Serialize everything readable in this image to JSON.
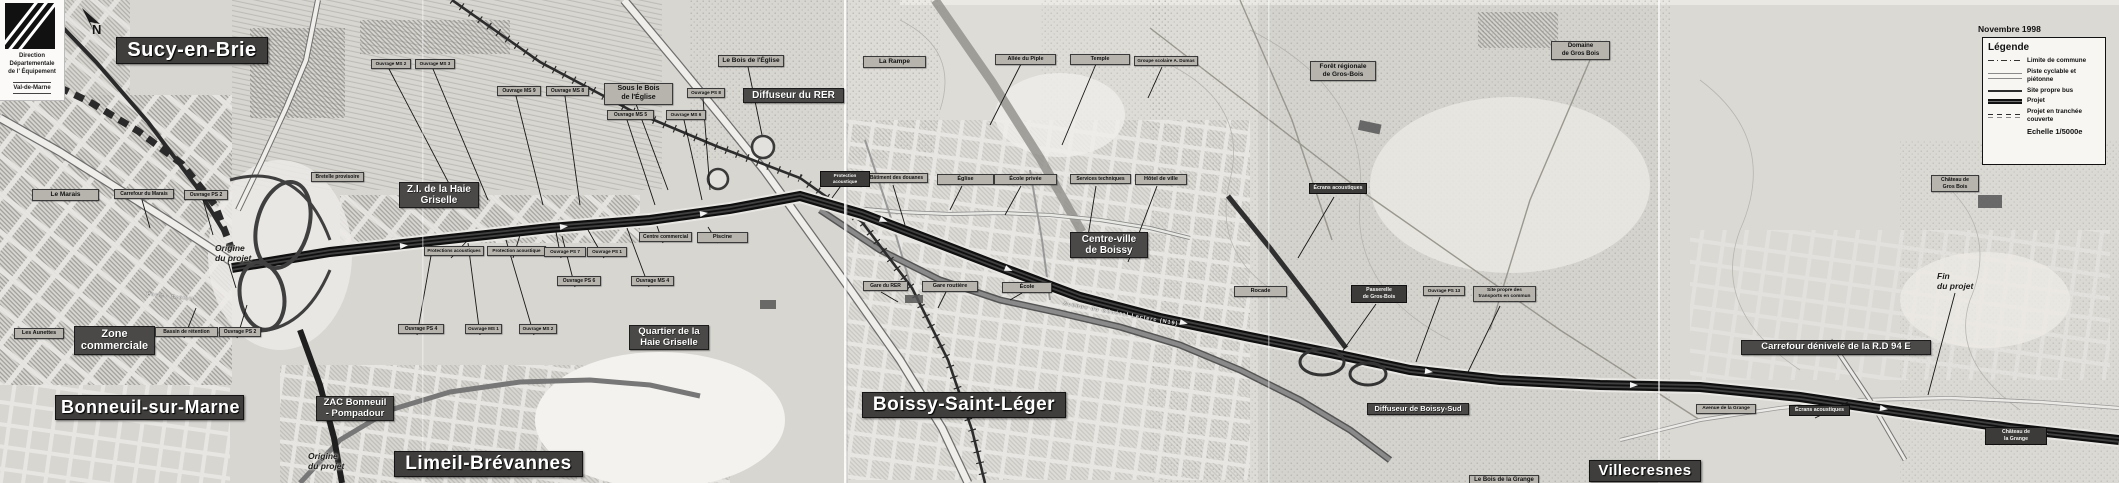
{
  "meta": {
    "date_note": "Novembre 1998"
  },
  "logo": {
    "line1": "Direction",
    "line2": "Départementale",
    "line3": "de l' Équipement",
    "line4": "Val-de-Marne"
  },
  "north": {
    "letter": "N"
  },
  "palette": {
    "paper": "#d8d6d1",
    "banner_dark": "#3f3e3c",
    "label_gray": "#b7b4ae",
    "route_dark": "#161616"
  },
  "legend": {
    "title": "Légende",
    "items": [
      {
        "symbol": "dashdot",
        "label": "Limite de commune"
      },
      {
        "symbol": "double",
        "label": "Piste cyclable et\npiétonne"
      },
      {
        "symbol": "solid",
        "label": "Site propre bus"
      },
      {
        "symbol": "thick",
        "label": "Projet"
      },
      {
        "symbol": "dashes",
        "label": "Projet en tranchée\ncouverte"
      },
      {
        "symbol": "none",
        "label": "Echelle 1/5000e",
        "emph": true
      }
    ]
  },
  "labels": [
    {
      "name": "commune-sucy-en-brie",
      "type": "xl",
      "text": "Sucy-en-Brie",
      "x": 116,
      "y": 37,
      "w": 140,
      "fs": 20
    },
    {
      "name": "commune-bonneuil-sur-marne",
      "type": "xl",
      "text": "Bonneuil-sur-Marne",
      "x": 55,
      "y": 395,
      "w": 177,
      "fs": 18
    },
    {
      "name": "commune-limeil-brevannes",
      "type": "xl",
      "text": "Limeil-Brévannes",
      "x": 394,
      "y": 451,
      "w": 177,
      "fs": 19
    },
    {
      "name": "commune-boissy-saint-leger",
      "type": "xl",
      "text": "Boissy-Saint-Léger",
      "x": 862,
      "y": 392,
      "w": 192,
      "fs": 19
    },
    {
      "name": "commune-villecresnes",
      "type": "xl",
      "text": "Villecresnes",
      "x": 1589,
      "y": 460,
      "w": 100,
      "fs": 15
    },
    {
      "name": "zi-haie-griselle",
      "type": "md",
      "text": "Z.I. de la Haie\nGriselle",
      "x": 399,
      "y": 182,
      "w": 72,
      "fs": 10
    },
    {
      "name": "zone-commerciale",
      "type": "md",
      "text": "Zone\ncommerciale",
      "x": 74,
      "y": 326,
      "w": 73,
      "fs": 11
    },
    {
      "name": "quartier-haie-griselle",
      "type": "md",
      "text": "Quartier de la\nHaie Griselle",
      "x": 629,
      "y": 325,
      "w": 72,
      "fs": 9.5
    },
    {
      "name": "centre-ville-boissy",
      "type": "md",
      "text": "Centre-ville\nde Boissy",
      "x": 1070,
      "y": 232,
      "w": 70,
      "fs": 10
    },
    {
      "name": "diffuseur-du-rer",
      "type": "md",
      "text": "Diffuseur du RER",
      "x": 743,
      "y": 88,
      "w": 93,
      "fs": 10
    },
    {
      "name": "diffuseur-boissy-sud",
      "type": "md",
      "text": "Diffuseur de Boissy-Sud",
      "x": 1367,
      "y": 403,
      "w": 94,
      "fs": 7.5
    },
    {
      "name": "carrefour-denivele-rd94e",
      "type": "md",
      "text": "Carrefour dénivelé de la R.D 94 E",
      "x": 1741,
      "y": 340,
      "w": 182,
      "fs": 9.5
    },
    {
      "name": "zac-bonneuil-pompadour",
      "type": "md",
      "text": "ZAC Bonneuil\n- Pompadour",
      "x": 316,
      "y": 396,
      "w": 70,
      "fs": 9.5
    },
    {
      "name": "le-marais",
      "type": "gray",
      "text": "Le Marais",
      "x": 32,
      "y": 189,
      "w": 61,
      "fs": 6.5
    },
    {
      "name": "carrefour-du-marais",
      "type": "gray",
      "text": "Carrefour du Marais",
      "x": 114,
      "y": 189,
      "w": 54,
      "fs": 5
    },
    {
      "name": "ouvrage-ps2-nord",
      "type": "gray",
      "text": "Ouvrage PS 2",
      "x": 184,
      "y": 190,
      "w": 38,
      "fs": 5
    },
    {
      "name": "les-aunettes",
      "type": "gray",
      "text": "Les Aunettes",
      "x": 14,
      "y": 328,
      "w": 44,
      "fs": 5.5
    },
    {
      "name": "bassin-de-retention",
      "type": "gray",
      "text": "Bassin de rétention",
      "x": 155,
      "y": 327,
      "w": 57,
      "fs": 5
    },
    {
      "name": "ouvrage-ps2-sud",
      "type": "gray",
      "text": "Ouvrage PS 2",
      "x": 219,
      "y": 327,
      "w": 36,
      "fs": 5
    },
    {
      "name": "bretelle-provisoire",
      "type": "gray",
      "text": "Bretelle provisoire",
      "x": 311,
      "y": 172,
      "w": 47,
      "fs": 5
    },
    {
      "name": "ouvrage-ms2-haut",
      "type": "gray",
      "text": "Ouvrage MS 2",
      "x": 371,
      "y": 59,
      "w": 34,
      "fs": 4.6
    },
    {
      "name": "ouvrage-ms3-haut",
      "type": "gray",
      "text": "Ouvrage MS 3",
      "x": 415,
      "y": 59,
      "w": 34,
      "fs": 4.6
    },
    {
      "name": "ouvrage-ms9",
      "type": "gray",
      "text": "Ouvrage MS 9",
      "x": 497,
      "y": 86,
      "w": 38,
      "fs": 5
    },
    {
      "name": "ouvrage-ms8",
      "type": "gray",
      "text": "Ouvrage MS 8",
      "x": 546,
      "y": 86,
      "w": 37,
      "fs": 5
    },
    {
      "name": "sous-le-bois-de-l-eglise",
      "type": "graylg",
      "text": "Sous le Bois\nde l'Église",
      "x": 604,
      "y": 83,
      "w": 63,
      "fs": 7
    },
    {
      "name": "ouvrage-ps8",
      "type": "gray",
      "text": "Ouvrage PS 8",
      "x": 687,
      "y": 88,
      "w": 32,
      "fs": 4.6
    },
    {
      "name": "ouvrage-ms5",
      "type": "gray",
      "text": "Ouvrage MS 5",
      "x": 607,
      "y": 110,
      "w": 41,
      "fs": 5
    },
    {
      "name": "ouvrage-ms6",
      "type": "gray",
      "text": "Ouvrage MS 6",
      "x": 666,
      "y": 110,
      "w": 34,
      "fs": 4.6
    },
    {
      "name": "le-bois-de-l-eglise",
      "type": "graylg",
      "text": "Le Bois de l'Église",
      "x": 718,
      "y": 55,
      "w": 60,
      "fs": 6.5
    },
    {
      "name": "la-rampe",
      "type": "graylg",
      "text": "La Rampe",
      "x": 863,
      "y": 56,
      "w": 57,
      "fs": 6.5
    },
    {
      "name": "protections-acoustiques",
      "type": "gray",
      "text": "Protections acoustiques",
      "x": 424,
      "y": 246,
      "w": 54,
      "fs": 4.6
    },
    {
      "name": "protection-acoustique-n5",
      "type": "gray",
      "text": "Protection acoustique",
      "x": 487,
      "y": 246,
      "w": 53,
      "fs": 4.6
    },
    {
      "name": "ouvrage-ps7",
      "type": "gray",
      "text": "Ouvrage PS 7",
      "x": 544,
      "y": 247,
      "w": 36,
      "fs": 4.6
    },
    {
      "name": "ouvrage-ps1",
      "type": "gray",
      "text": "Ouvrage PS 1",
      "x": 587,
      "y": 247,
      "w": 34,
      "fs": 4.6
    },
    {
      "name": "ouvrage-ps6",
      "type": "gray",
      "text": "Ouvrage PS 6",
      "x": 557,
      "y": 276,
      "w": 38,
      "fs": 5
    },
    {
      "name": "ouvrage-ms4",
      "type": "gray",
      "text": "Ouvrage MS 4",
      "x": 631,
      "y": 276,
      "w": 37,
      "fs": 5
    },
    {
      "name": "ouvrage-ps4",
      "type": "gray",
      "text": "Ouvrage PS 4",
      "x": 398,
      "y": 324,
      "w": 40,
      "fs": 5
    },
    {
      "name": "ouvrage-ms1",
      "type": "gray",
      "text": "Ouvrage MS 1",
      "x": 465,
      "y": 324,
      "w": 31,
      "fs": 4.6
    },
    {
      "name": "ouvrage-ms2",
      "type": "gray",
      "text": "Ouvrage MS 2",
      "x": 519,
      "y": 324,
      "w": 32,
      "fs": 4.6
    },
    {
      "name": "centre-commercial",
      "type": "gray",
      "text": "Centre commercial",
      "x": 639,
      "y": 232,
      "w": 47,
      "fs": 5
    },
    {
      "name": "piscine",
      "type": "gray",
      "text": "Piscine",
      "x": 697,
      "y": 232,
      "w": 45,
      "fs": 5.5
    },
    {
      "name": "batiment-des-douanes",
      "type": "gray",
      "text": "Bâtiment des douanes",
      "x": 865,
      "y": 173,
      "w": 57,
      "fs": 5
    },
    {
      "name": "eglise",
      "type": "gray",
      "text": "Église",
      "x": 937,
      "y": 174,
      "w": 51,
      "fs": 5.5
    },
    {
      "name": "ecole-privee",
      "type": "gray",
      "text": "École privée",
      "x": 994,
      "y": 174,
      "w": 57,
      "fs": 5.5
    },
    {
      "name": "services-techniques",
      "type": "gray",
      "text": "Services techniques",
      "x": 1070,
      "y": 174,
      "w": 55,
      "fs": 5
    },
    {
      "name": "hotel-de-ville",
      "type": "gray",
      "text": "Hôtel de ville",
      "x": 1135,
      "y": 174,
      "w": 46,
      "fs": 5.5
    },
    {
      "name": "gare-du-rer",
      "type": "gray",
      "text": "Gare du RER",
      "x": 863,
      "y": 281,
      "w": 39,
      "fs": 5
    },
    {
      "name": "gare-routiere",
      "type": "gray",
      "text": "Gare routière",
      "x": 922,
      "y": 281,
      "w": 50,
      "fs": 5.5
    },
    {
      "name": "ecole",
      "type": "gray",
      "text": "École",
      "x": 1002,
      "y": 282,
      "w": 44,
      "fs": 5.5
    },
    {
      "name": "allee-du-piple",
      "type": "gray",
      "text": "Allée du Piple",
      "x": 995,
      "y": 54,
      "w": 55,
      "fs": 5.5
    },
    {
      "name": "temple",
      "type": "gray",
      "text": "Temple",
      "x": 1070,
      "y": 54,
      "w": 54,
      "fs": 5.5
    },
    {
      "name": "groupe-scolaire-a-dumas",
      "type": "gray",
      "text": "Groupe scolaire A. Dumas",
      "x": 1134,
      "y": 56,
      "w": 58,
      "fs": 4.6
    },
    {
      "name": "foret-regionale-de-gros-bois",
      "type": "graylg",
      "text": "Forêt régionale\nde Gros-Bois",
      "x": 1310,
      "y": 61,
      "w": 60,
      "fs": 6.5
    },
    {
      "name": "domaine-de-gros-bois",
      "type": "graylg",
      "text": "Domaine\nde Gros Bois",
      "x": 1551,
      "y": 41,
      "w": 53,
      "fs": 6
    },
    {
      "name": "rocade",
      "type": "gray",
      "text": "Rocade",
      "x": 1234,
      "y": 286,
      "w": 47,
      "fs": 5.5
    },
    {
      "name": "ouvrage-ps13",
      "type": "gray",
      "text": "Ouvrage PS 13",
      "x": 1423,
      "y": 286,
      "w": 36,
      "fs": 4.6
    },
    {
      "name": "site-propre-transports",
      "type": "gray",
      "text": "Site propre des\ntransports en commun",
      "x": 1473,
      "y": 286,
      "w": 57,
      "fs": 4.8
    },
    {
      "name": "avenue-de-la-grange",
      "type": "gray",
      "text": "Avenue de la Grange",
      "x": 1696,
      "y": 404,
      "w": 54,
      "fs": 4.8
    },
    {
      "name": "le-bois-de-la-grange",
      "type": "graylg",
      "text": "Le Bois de la Grange",
      "x": 1469,
      "y": 475,
      "w": 64,
      "fs": 6
    },
    {
      "name": "chateau-de-gros-bois",
      "type": "gray",
      "text": "Château de\nGros Bois",
      "x": 1931,
      "y": 175,
      "w": 42,
      "fs": 5.2
    },
    {
      "name": "protection-acoustique-dark",
      "type": "dark",
      "text": "Protection acoustique",
      "x": 820,
      "y": 171,
      "w": 44,
      "fs": 4.6
    },
    {
      "name": "ecrans-acoustiques",
      "type": "dark",
      "text": "Écrans acoustiques",
      "x": 1309,
      "y": 183,
      "w": 52,
      "fs": 5.2
    },
    {
      "name": "passerelle-de-gros-bois",
      "type": "dark",
      "text": "Passerelle\nde Gros-Bois",
      "x": 1351,
      "y": 285,
      "w": 50,
      "fs": 5.2
    },
    {
      "name": "ecrans-acoustiques-est",
      "type": "dark",
      "text": "Écrans acoustiques",
      "x": 1789,
      "y": 405,
      "w": 55,
      "fs": 5.2
    },
    {
      "name": "chateau-de-la-grange",
      "type": "dark",
      "text": "Château de\nla Grange",
      "x": 1985,
      "y": 427,
      "w": 56,
      "fs": 5.2
    },
    {
      "name": "origine-du-projet-nord",
      "type": "it",
      "text": "Origine\ndu projet",
      "x": 215,
      "y": 243,
      "fs": 8.5
    },
    {
      "name": "origine-du-projet-sud",
      "type": "it",
      "text": "Origine\ndu projet",
      "x": 308,
      "y": 451,
      "fs": 8.5
    },
    {
      "name": "fin-du-projet",
      "type": "it",
      "text": "Fin\ndu projet",
      "x": 1937,
      "y": 271,
      "fs": 8.5
    },
    {
      "name": "street-avenue-general-leclerc",
      "type": "street",
      "text": "Avenue du Général Leclerc (N19)",
      "x": 1063,
      "y": 301,
      "fs": 5.5,
      "rot": 10
    },
    {
      "name": "street-paris-creteil",
      "type": "street",
      "text": "Paris - Créteil",
      "x": 147,
      "y": 291,
      "fs": 5,
      "rot": 7
    }
  ]
}
